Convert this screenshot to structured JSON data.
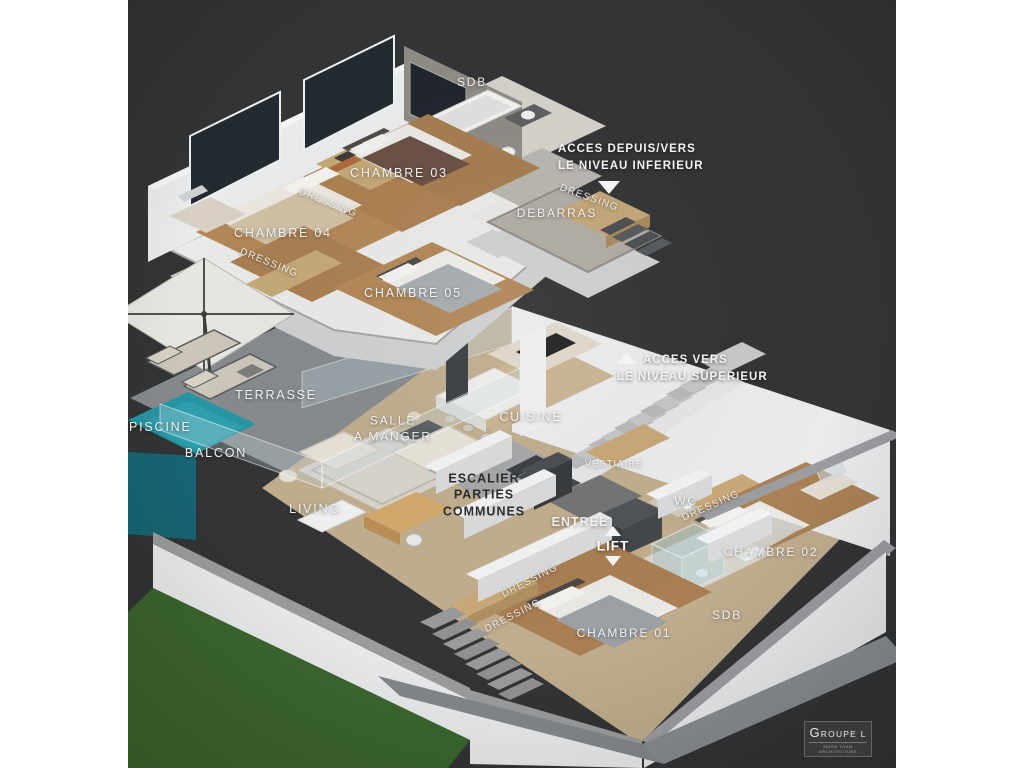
{
  "scene_title": "3D duplex floor plan rendering",
  "labels": {
    "sdb_upper": "SDB",
    "chambre_03": "CHAMBRE 03",
    "chambre_04": "CHAMBRE 04",
    "chambre_05": "CHAMBRE 05",
    "dressing": "DRESSING",
    "debarras": "DEBARRAS",
    "terrasse": "TERRASSE",
    "piscine": "PISCINE",
    "balcon": "BALCON",
    "salle_a_manger_line1": "SALLE",
    "salle_a_manger_line2": "A MANGER",
    "cuisine": "CUISINE",
    "vestiaire": "VESTIAIRE",
    "living": "LIVING",
    "escalier_line1": "ESCALIER",
    "escalier_line2": "PARTIES",
    "escalier_line3": "COMMUNES",
    "entree": "ENTREE",
    "lift": "LIFT",
    "wc": "WC",
    "chambre_02": "CHAMBRE 02",
    "sdb_lower": "SDB",
    "chambre_01": "CHAMBRE 01"
  },
  "annotations": {
    "acces_inferieur": {
      "line1": "ACCES DEPUIS/VERS",
      "line2": "LE NIVEAU INFERIEUR",
      "arrow": "down"
    },
    "acces_superieur": {
      "line1": "ACCES VERS",
      "line2": "LE NIVEAU SUPERIEUR",
      "arrow": "up"
    }
  },
  "logo": {
    "name": "GROUPE L",
    "tagline": "MORE THAN ARCHITECTURE"
  },
  "colors": {
    "background_panel": "#323436",
    "page_margins": "#ffffff",
    "walls_white": "#e9ebed",
    "concrete_gray": "#9b9da0",
    "wood_floor": "#b28758",
    "grass_green": "#3c672e",
    "pool_teal": "#2795a4",
    "label_text": "#f0f0ef",
    "dark_label_text": "#2b2d2f"
  }
}
